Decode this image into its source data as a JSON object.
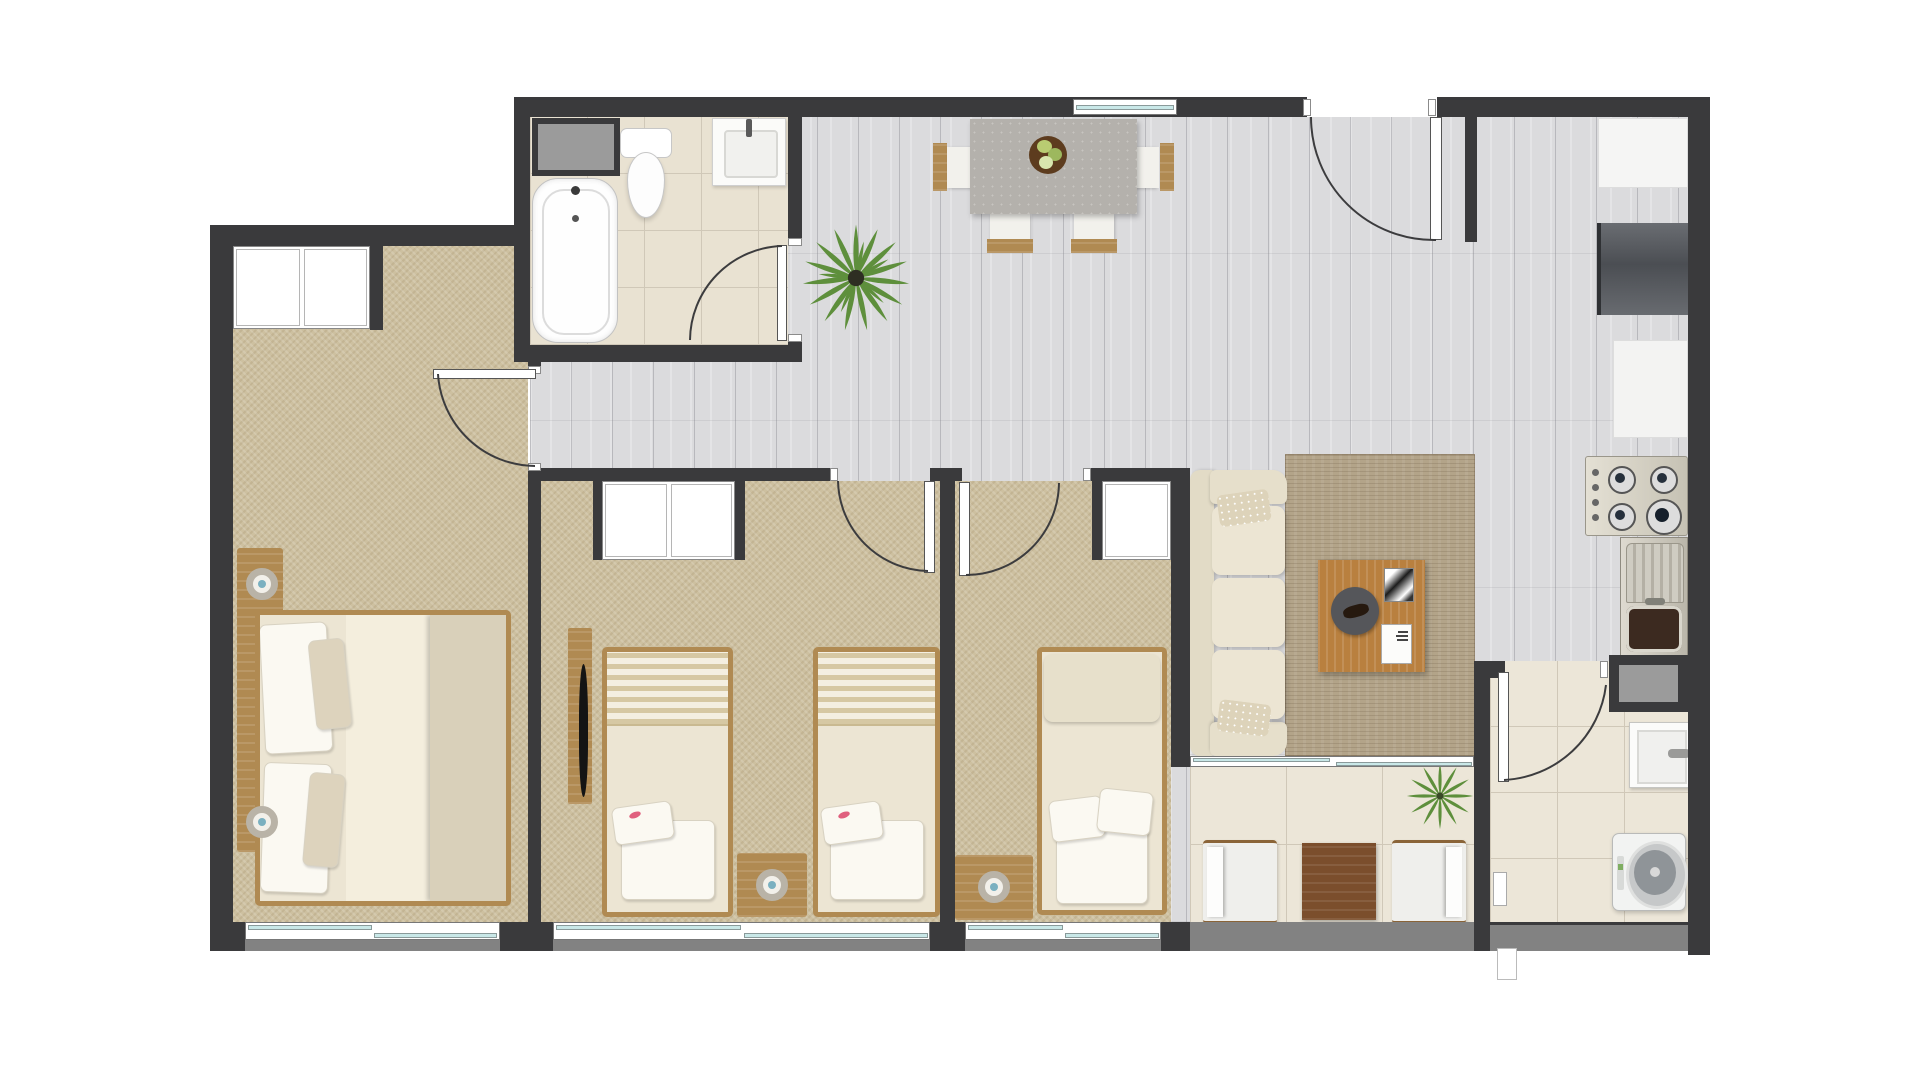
{
  "meta": {
    "kind": "apartment-floor-plan-rendering",
    "view": "top-down",
    "visible_text": ""
  },
  "palette": {
    "wall": "#3a3a3c",
    "wood_floor": "#dbdbdd",
    "carpet": "#cdc0a0",
    "bath_tile": "#e9e2d2",
    "light_tile": "#ece6d8",
    "rug": "#b3a489",
    "cream_fabric": "#ece5d3",
    "wood": "#b08a52",
    "dark_wood": "#7b4e2c",
    "steel": "#d8d4c6",
    "window_glass": "#c9e8e8",
    "gray_box": "#9b9b9b",
    "stone_table": "#b4b1ac",
    "plant_green": "#5e8f3c",
    "accent_pink": "#e0607e"
  },
  "rooms": [
    {
      "id": "master-bedroom",
      "label": "bedroom-master",
      "furniture": [
        "double-bed",
        "headboard-nightstands",
        "two-lamps",
        "wardrobe",
        "window"
      ]
    },
    {
      "id": "bedroom-2",
      "label": "bedroom-2",
      "furniture": [
        "single-bed",
        "single-bed",
        "nightstand",
        "lamp",
        "wardrobe",
        "tv-panel",
        "window"
      ]
    },
    {
      "id": "bedroom-3",
      "label": "bedroom-3",
      "furniture": [
        "single-bed",
        "nightstand",
        "lamp",
        "wardrobe",
        "window"
      ]
    },
    {
      "id": "bathroom",
      "label": "bathroom",
      "furniture": [
        "bathtub",
        "toilet",
        "vanity-sink",
        "utility-shaft",
        "door"
      ]
    },
    {
      "id": "hallway",
      "label": "hallway",
      "furniture": []
    },
    {
      "id": "dining-area",
      "label": "dining-area",
      "furniture": [
        "stone-table",
        "four-chairs",
        "fruit-bowl",
        "plant"
      ]
    },
    {
      "id": "entry",
      "label": "entry",
      "furniture": [
        "entry-door",
        "top-window"
      ]
    },
    {
      "id": "kitchen",
      "label": "kitchen",
      "furniture": [
        "counter-white",
        "refrigerator-dark",
        "counter-white-2",
        "gas-stove-4-burners",
        "sink-with-drainboard",
        "gray-cabinet"
      ]
    },
    {
      "id": "living-room",
      "label": "living-room",
      "furniture": [
        "three-seat-sofa",
        "area-rug",
        "coffee-table",
        "round-tray",
        "books",
        "sliding-window"
      ]
    },
    {
      "id": "terrace",
      "label": "terrace",
      "furniture": [
        "lounge-chair",
        "lounge-chair",
        "wood-table",
        "plant",
        "balcony-edge"
      ]
    },
    {
      "id": "laundry",
      "label": "laundry-area",
      "furniture": [
        "laundry-sink",
        "top-load-washer",
        "door",
        "wall-unit"
      ]
    }
  ]
}
